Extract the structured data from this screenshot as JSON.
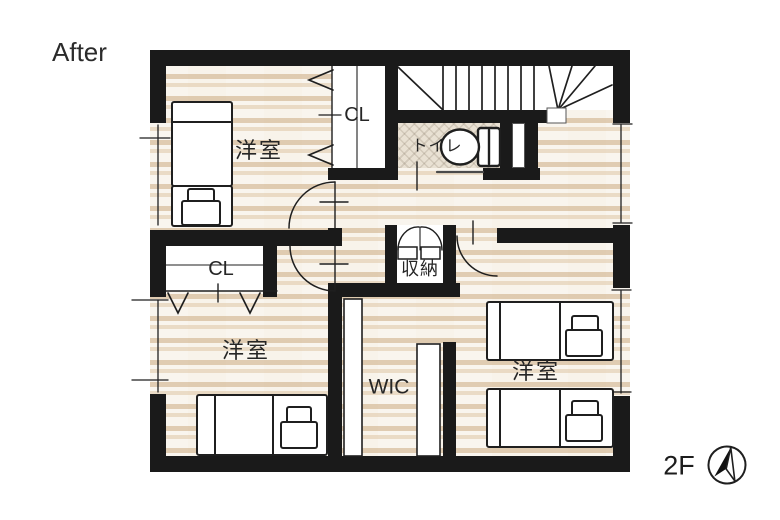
{
  "title": "After",
  "floor_label": "2F",
  "rooms": {
    "bedroom_top_left": {
      "label": "洋室"
    },
    "bedroom_bottom_left": {
      "label": "洋室"
    },
    "bedroom_right": {
      "label": "洋室"
    },
    "closet_top": {
      "label": "CL"
    },
    "closet_bottom": {
      "label": "CL"
    },
    "toilet": {
      "label": "トイレ"
    },
    "storage": {
      "label": "収納"
    },
    "walk_in_closet": {
      "label": "WIC"
    }
  },
  "compass": {
    "icon": "north-arrow"
  },
  "colors": {
    "paper": "#ffffff",
    "wall": "#1a1a1a",
    "wood_bg": "#f8f3ea",
    "wood": "#d3b48e",
    "tile": "#e9e1d3",
    "line": "#1f1f1f",
    "text": "#262626"
  }
}
